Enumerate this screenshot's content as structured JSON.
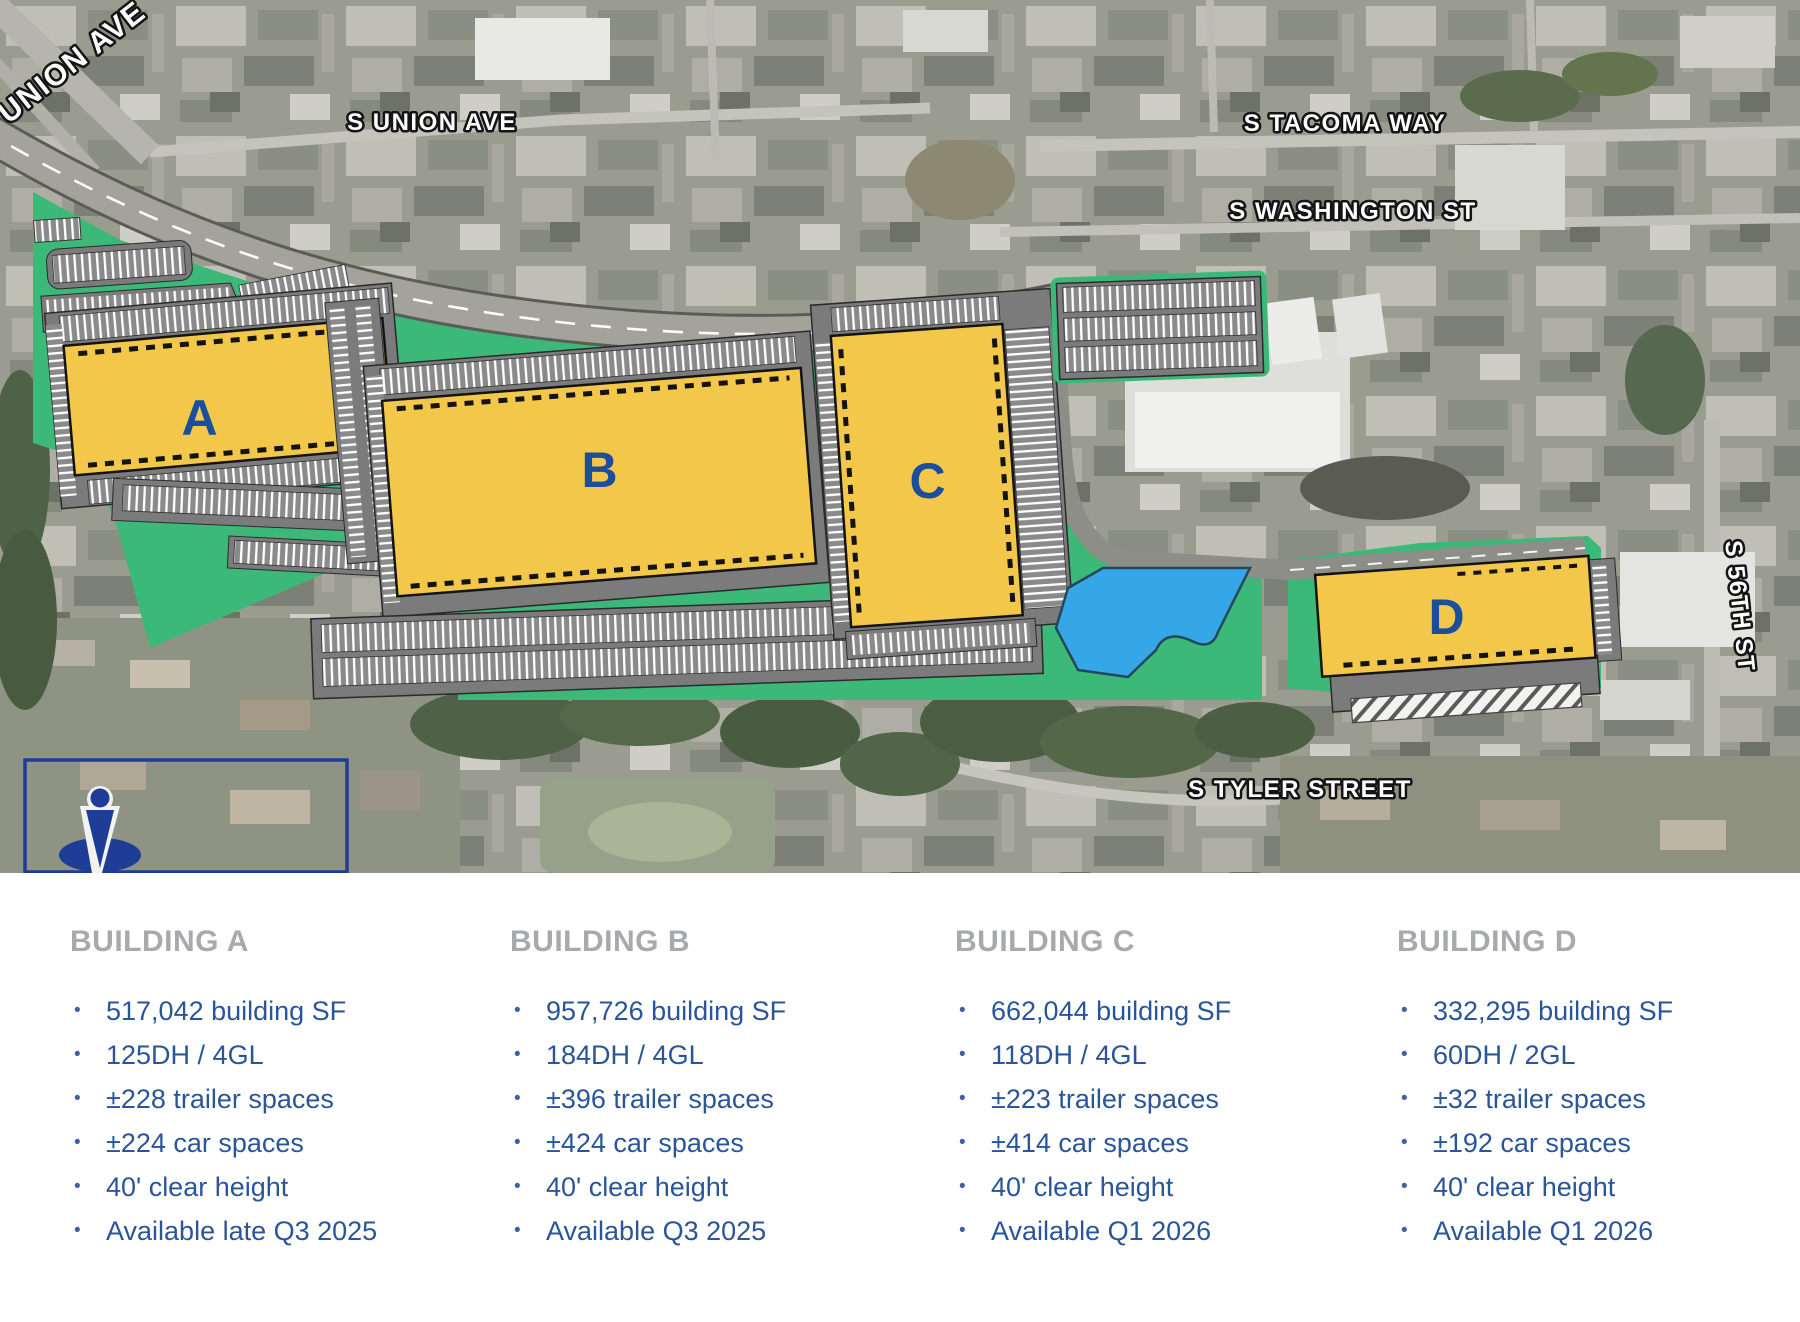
{
  "map": {
    "streets": {
      "union_ave": "UNION AVE",
      "s_union_ave": "S UNION AVE",
      "s_tacoma_way": "S TACOMA WAY",
      "s_washington_st": "S WASHINGTON ST",
      "s_56th_st": "S 56TH ST",
      "s_tyler_street": "S TYLER STREET"
    },
    "markers": {
      "a": "A",
      "b": "B",
      "c": "C",
      "d": "D"
    },
    "colors": {
      "building_yellow": "#F3C74A",
      "site_green": "#3CB878",
      "pond_blue": "#35A7E6",
      "marker_blue": "#1B4F9E",
      "parking_gray": "#7B7B7B",
      "logo_navy": "#1E3D96"
    }
  },
  "details": {
    "buildings": [
      {
        "name": "BUILDING A",
        "specs": [
          "517,042 building SF",
          "125DH / 4GL",
          "±228 trailer spaces",
          "±224 car spaces",
          "40' clear height",
          "Available late Q3 2025"
        ]
      },
      {
        "name": "BUILDING B",
        "specs": [
          "957,726 building SF",
          "184DH / 4GL",
          "±396 trailer spaces",
          "±424 car spaces",
          "40' clear height",
          "Available Q3 2025"
        ]
      },
      {
        "name": "BUILDING C",
        "specs": [
          "662,044 building SF",
          "118DH / 4GL",
          "±223 trailer spaces",
          "±414 car spaces",
          "40' clear height",
          "Available Q1 2026"
        ]
      },
      {
        "name": "BUILDING D",
        "specs": [
          "332,295 building SF",
          "60DH / 2GL",
          "±32 trailer spaces",
          "±192 car spaces",
          "40' clear height",
          "Available Q1 2026"
        ]
      }
    ]
  }
}
